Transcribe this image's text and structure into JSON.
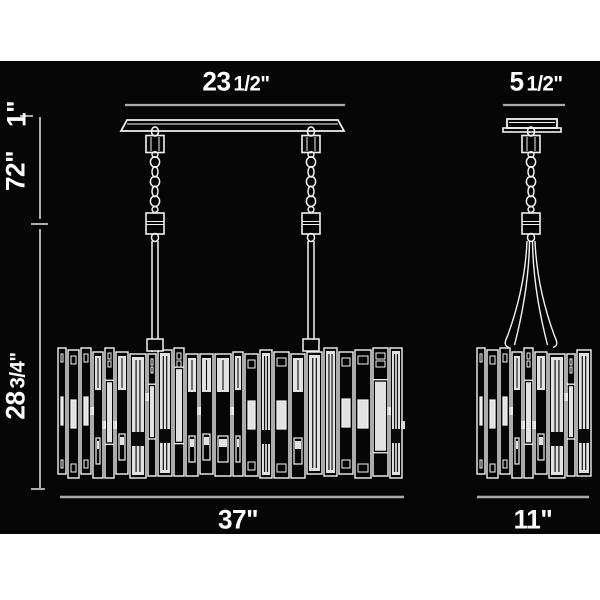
{
  "colors": {
    "page_background": "#ffffff",
    "panel_background": "#060606",
    "line": "#f2f2f2",
    "dimension_line": "#ababab",
    "text": "#ffffff",
    "crystal_fill": "#e2e2e2",
    "crystal_dark": "#0a0a0a",
    "flute_line": "#111111"
  },
  "labels": {
    "front_canopy_width_big": "23",
    "front_canopy_width_small": "1/2\"",
    "side_canopy_width_big": "5",
    "side_canopy_width_small": "1/2\"",
    "canopy_height": "1\"",
    "max_height": "72\"",
    "body_height_big": "28",
    "body_height_small": "3/4\"",
    "front_shade_width": "37\"",
    "side_shade_width": "11\""
  }
}
